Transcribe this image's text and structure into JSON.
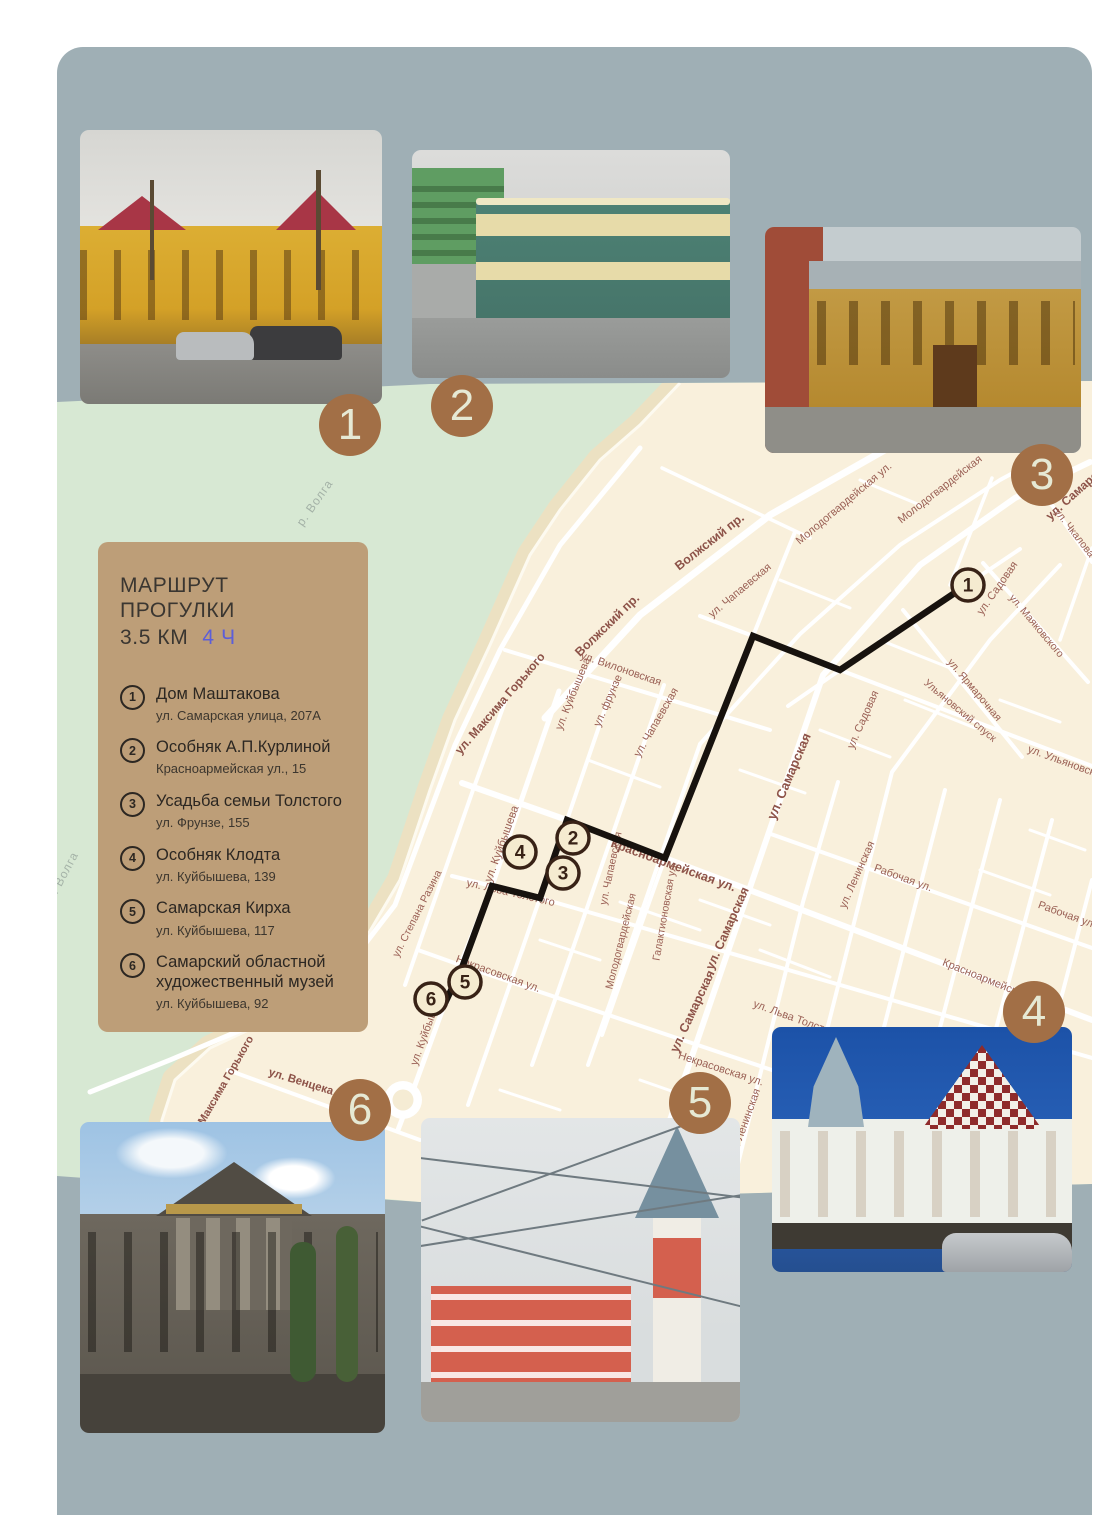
{
  "colors": {
    "page_bg": "#ffffff",
    "board_bg": "#9fafb5",
    "water": "#d7e8d3",
    "land": "#f9f0dc",
    "beach": "#ece1c2",
    "legend_bg": "#bd9e78",
    "badge_bg": "#a26f46",
    "badge_text": "#e6e9d4",
    "route": "#17120e",
    "marker_fill": "#f5ebd0",
    "marker_border": "#382216",
    "duration_accent": "#5c5ed8"
  },
  "legend": {
    "title_line1": "МАРШРУТ ПРОГУЛКИ",
    "distance": "3.5 КМ",
    "duration": "4 Ч",
    "items": [
      {
        "num": "1",
        "name": "Дом Маштакова",
        "address": "ул. Самарская улица, 207А"
      },
      {
        "num": "2",
        "name": "Особняк А.П.Курлиной",
        "address": "Красноармейская ул., 15"
      },
      {
        "num": "3",
        "name": "Усадьба семьи Толстого",
        "address": "ул. Фрунзе, 155"
      },
      {
        "num": "4",
        "name": "Особняк Клодта",
        "address": "ул. Куйбышева, 139"
      },
      {
        "num": "5",
        "name": "Самарская Кирха",
        "address": "ул. Куйбышева, 117"
      },
      {
        "num": "6",
        "name": "Самарский областной художественный музей",
        "address": "ул. Куйбышева, 92"
      }
    ]
  },
  "badges": [
    {
      "num": "1",
      "x": 350,
      "y": 425
    },
    {
      "num": "2",
      "x": 462,
      "y": 406
    },
    {
      "num": "3",
      "x": 1042,
      "y": 475
    },
    {
      "num": "4",
      "x": 1034,
      "y": 1012
    },
    {
      "num": "5",
      "x": 700,
      "y": 1103
    },
    {
      "num": "6",
      "x": 360,
      "y": 1110
    }
  ],
  "photos": [
    {
      "num": "1",
      "description": "Дом Маштакова — жёлтый деревянный дом с красными крышами, мокрая улица с машинами"
    },
    {
      "num": "2",
      "description": "Особняк А.П.Курлиной — зелёно-бежевый угловой особняк в стиле модерн в дождь"
    },
    {
      "num": "3",
      "description": "Усадьба семьи Толстого — деревянный жёлто-коричневый особняк"
    },
    {
      "num": "4",
      "description": "Особняк Клодта — белый особняк с шахматной красно-белой крышей на фоне синего неба"
    },
    {
      "num": "5",
      "description": "Самарская Кирха — красная кирха с высоким шпилем и проводами"
    },
    {
      "num": "6",
      "description": "Самарский областной художественный музей — здание с колоннами и фронтоном"
    }
  ],
  "map": {
    "route_points": "968,584 840,670 753,636 665,858 567,820 540,898 492,886 463,965 445,1003",
    "markers": [
      {
        "num": "1",
        "x": 968,
        "y": 585
      },
      {
        "num": "2",
        "x": 573,
        "y": 838
      },
      {
        "num": "3",
        "x": 563,
        "y": 873
      },
      {
        "num": "4",
        "x": 520,
        "y": 852
      },
      {
        "num": "5",
        "x": 465,
        "y": 982
      },
      {
        "num": "6",
        "x": 431,
        "y": 999
      }
    ],
    "water_labels": [
      {
        "t": "р. Волга",
        "x": 318,
        "y": 505,
        "r": -55,
        "s": 12
      },
      {
        "t": "р. Волга",
        "x": 66,
        "y": 878,
        "r": -62,
        "s": 12
      }
    ],
    "street_labels": [
      {
        "t": "ул. Максима Горького",
        "x": 503,
        "y": 706,
        "r": -49,
        "s": 12,
        "b": 1
      },
      {
        "t": "ул. Максима Горького",
        "x": 224,
        "y": 1090,
        "r": -60,
        "s": 11,
        "b": 1
      },
      {
        "t": "Волжский пр.",
        "x": 610,
        "y": 628,
        "r": -44,
        "s": 12.5,
        "b": 1
      },
      {
        "t": "Волжский пр.",
        "x": 712,
        "y": 545,
        "r": -38,
        "s": 12.5,
        "b": 1
      },
      {
        "t": "ул. Куйбышева",
        "x": 576,
        "y": 695,
        "r": -68,
        "s": 11,
        "b": 0
      },
      {
        "t": "ул. Куйбышева",
        "x": 505,
        "y": 845,
        "r": -70,
        "s": 11.5,
        "b": 0
      },
      {
        "t": "ул. Куйбышева",
        "x": 430,
        "y": 1030,
        "r": -70,
        "s": 11,
        "b": 0
      },
      {
        "t": "ул. фрунзе",
        "x": 611,
        "y": 702,
        "r": -66,
        "s": 11,
        "b": 0
      },
      {
        "t": "ул. Вилоновская",
        "x": 620,
        "y": 672,
        "r": 19,
        "s": 11,
        "b": 0
      },
      {
        "t": "ул. Чапаевская",
        "x": 659,
        "y": 724,
        "r": -60,
        "s": 11,
        "b": 0
      },
      {
        "t": "ул. Чапаевская",
        "x": 614,
        "y": 869,
        "r": -78,
        "s": 10.5,
        "b": 0
      },
      {
        "t": "ул. Чапаевская",
        "x": 742,
        "y": 593,
        "r": -40,
        "s": 11,
        "b": 0
      },
      {
        "t": "Молодогвардейская ул.",
        "x": 846,
        "y": 506,
        "r": -40,
        "s": 11,
        "b": 0
      },
      {
        "t": "Молодогвардейская",
        "x": 942,
        "y": 492,
        "r": -38,
        "s": 11,
        "b": 0
      },
      {
        "t": "Молодогвардейская",
        "x": 624,
        "y": 942,
        "r": -76,
        "s": 10.5,
        "b": 0
      },
      {
        "t": "Галактионовская ул.",
        "x": 668,
        "y": 912,
        "r": -80,
        "s": 10.5,
        "b": 0
      },
      {
        "t": "ул. Самарская",
        "x": 793,
        "y": 778,
        "r": -67,
        "s": 13,
        "b": 1
      },
      {
        "t": "ул. Самарская",
        "x": 731,
        "y": 930,
        "r": -66,
        "s": 12.5,
        "b": 1
      },
      {
        "t": "ул. Самарская",
        "x": 696,
        "y": 1013,
        "r": -65,
        "s": 12.5,
        "b": 1
      },
      {
        "t": "ул. Самарская",
        "x": 1082,
        "y": 492,
        "r": -42,
        "s": 12,
        "b": 1
      },
      {
        "t": "ул. Садовая",
        "x": 866,
        "y": 721,
        "r": -66,
        "s": 11,
        "b": 0
      },
      {
        "t": "ул. Садовая",
        "x": 1000,
        "y": 590,
        "r": -55,
        "s": 11,
        "b": 0
      },
      {
        "t": "ул. Ленинская",
        "x": 860,
        "y": 876,
        "r": -66,
        "s": 11,
        "b": 0
      },
      {
        "t": "ул. Ленинская",
        "x": 748,
        "y": 1124,
        "r": -70,
        "s": 11,
        "b": 0
      },
      {
        "t": "Красноармейская ул.",
        "x": 672,
        "y": 869,
        "r": 20,
        "s": 12.5,
        "b": 1
      },
      {
        "t": "Красноармейская",
        "x": 984,
        "y": 982,
        "r": 22,
        "s": 11,
        "b": 0
      },
      {
        "t": "ул. Льва Толстого",
        "x": 510,
        "y": 896,
        "r": 13,
        "s": 11,
        "b": 0
      },
      {
        "t": "ул. Льва Толстого",
        "x": 795,
        "y": 1022,
        "r": 20,
        "s": 11,
        "b": 0
      },
      {
        "t": "Некрасовская ул.",
        "x": 497,
        "y": 977,
        "r": 20,
        "s": 11,
        "b": 0
      },
      {
        "t": "Некрасовская ул.",
        "x": 720,
        "y": 1072,
        "r": 18,
        "s": 11,
        "b": 0
      },
      {
        "t": "ул. Венцека",
        "x": 300,
        "y": 1085,
        "r": 17,
        "s": 11.5,
        "b": 1
      },
      {
        "t": "ул. Ульяновская",
        "x": 1066,
        "y": 766,
        "r": 20,
        "s": 11,
        "b": 0
      },
      {
        "t": "Ульяновский спуск",
        "x": 958,
        "y": 713,
        "r": 40,
        "s": 10.5,
        "b": 0
      },
      {
        "t": "ул. Ярмарочная",
        "x": 972,
        "y": 692,
        "r": 50,
        "s": 10.5,
        "b": 0
      },
      {
        "t": "ул. Маяковского",
        "x": 1034,
        "y": 628,
        "r": 50,
        "s": 10.5,
        "b": 0
      },
      {
        "t": "ул. Чкалова",
        "x": 1072,
        "y": 535,
        "r": 52,
        "s": 10.5,
        "b": 0
      },
      {
        "t": "Рабочая ул.",
        "x": 902,
        "y": 881,
        "r": 20,
        "s": 11,
        "b": 0
      },
      {
        "t": "Рабочая ул.",
        "x": 1066,
        "y": 918,
        "r": 20,
        "s": 11,
        "b": 0
      },
      {
        "t": "ул. Степана Разина",
        "x": 420,
        "y": 915,
        "r": -63,
        "s": 10.5,
        "b": 0
      }
    ]
  }
}
